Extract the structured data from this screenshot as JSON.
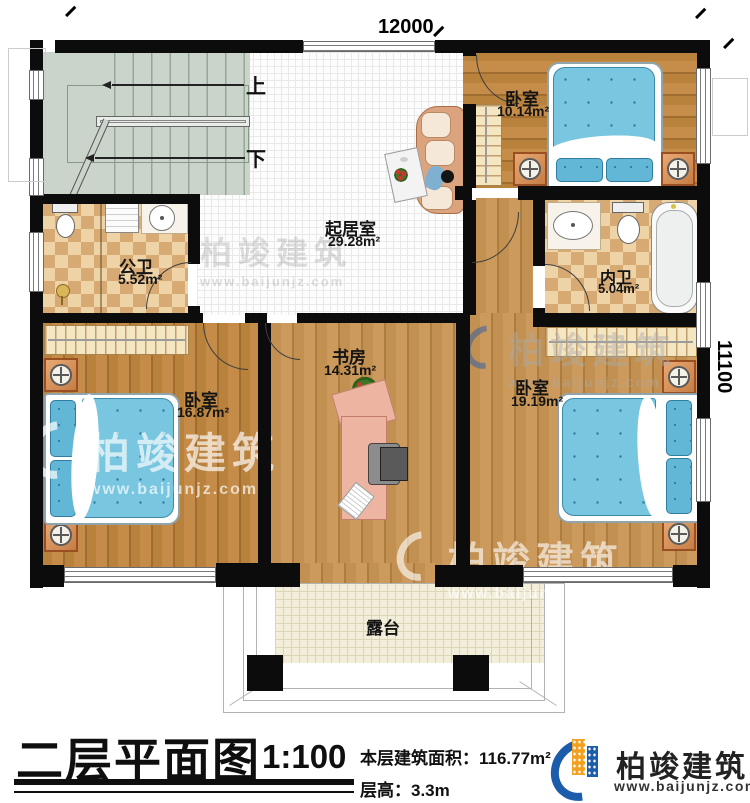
{
  "plan": {
    "dimensions": {
      "top": "12000",
      "right": "11100"
    },
    "stairs": {
      "up": "上",
      "down": "下"
    },
    "rooms": [
      {
        "id": "living",
        "name": "起居室",
        "area": "29.28m²"
      },
      {
        "id": "bedroom-top",
        "name": "卧室",
        "area": "10.14m²"
      },
      {
        "id": "public-bath",
        "name": "公卫",
        "area": "5.52m²"
      },
      {
        "id": "inner-bath",
        "name": "内卫",
        "area": "5.04m²"
      },
      {
        "id": "study",
        "name": "书房",
        "area": "14.31m²"
      },
      {
        "id": "bedroom-left",
        "name": "卧室",
        "area": "16.87m²"
      },
      {
        "id": "bedroom-right",
        "name": "卧室",
        "area": "19.19m²"
      },
      {
        "id": "terrace",
        "name": "露台",
        "area": ""
      }
    ]
  },
  "titleblock": {
    "title": "二层平面图",
    "scale": "1:100",
    "area_label": "本层建筑面积：",
    "area_value": "116.77m²",
    "height_label": "层高：",
    "height_value": "3.3m",
    "brand": "柏竣建筑",
    "website": "www.baijunjz.com"
  },
  "watermark": {
    "brand": "柏竣建筑",
    "website": "www.baijunjz.com"
  },
  "colors": {
    "wall": "#0c0c0c",
    "wood": "#b8813c",
    "tile_check": "#d7aa74",
    "bed_blue": "#79c6e0",
    "stair_green": "#cbd4ca",
    "brand_blue": "#1b5cab",
    "brand_orange": "#f4a01f"
  }
}
